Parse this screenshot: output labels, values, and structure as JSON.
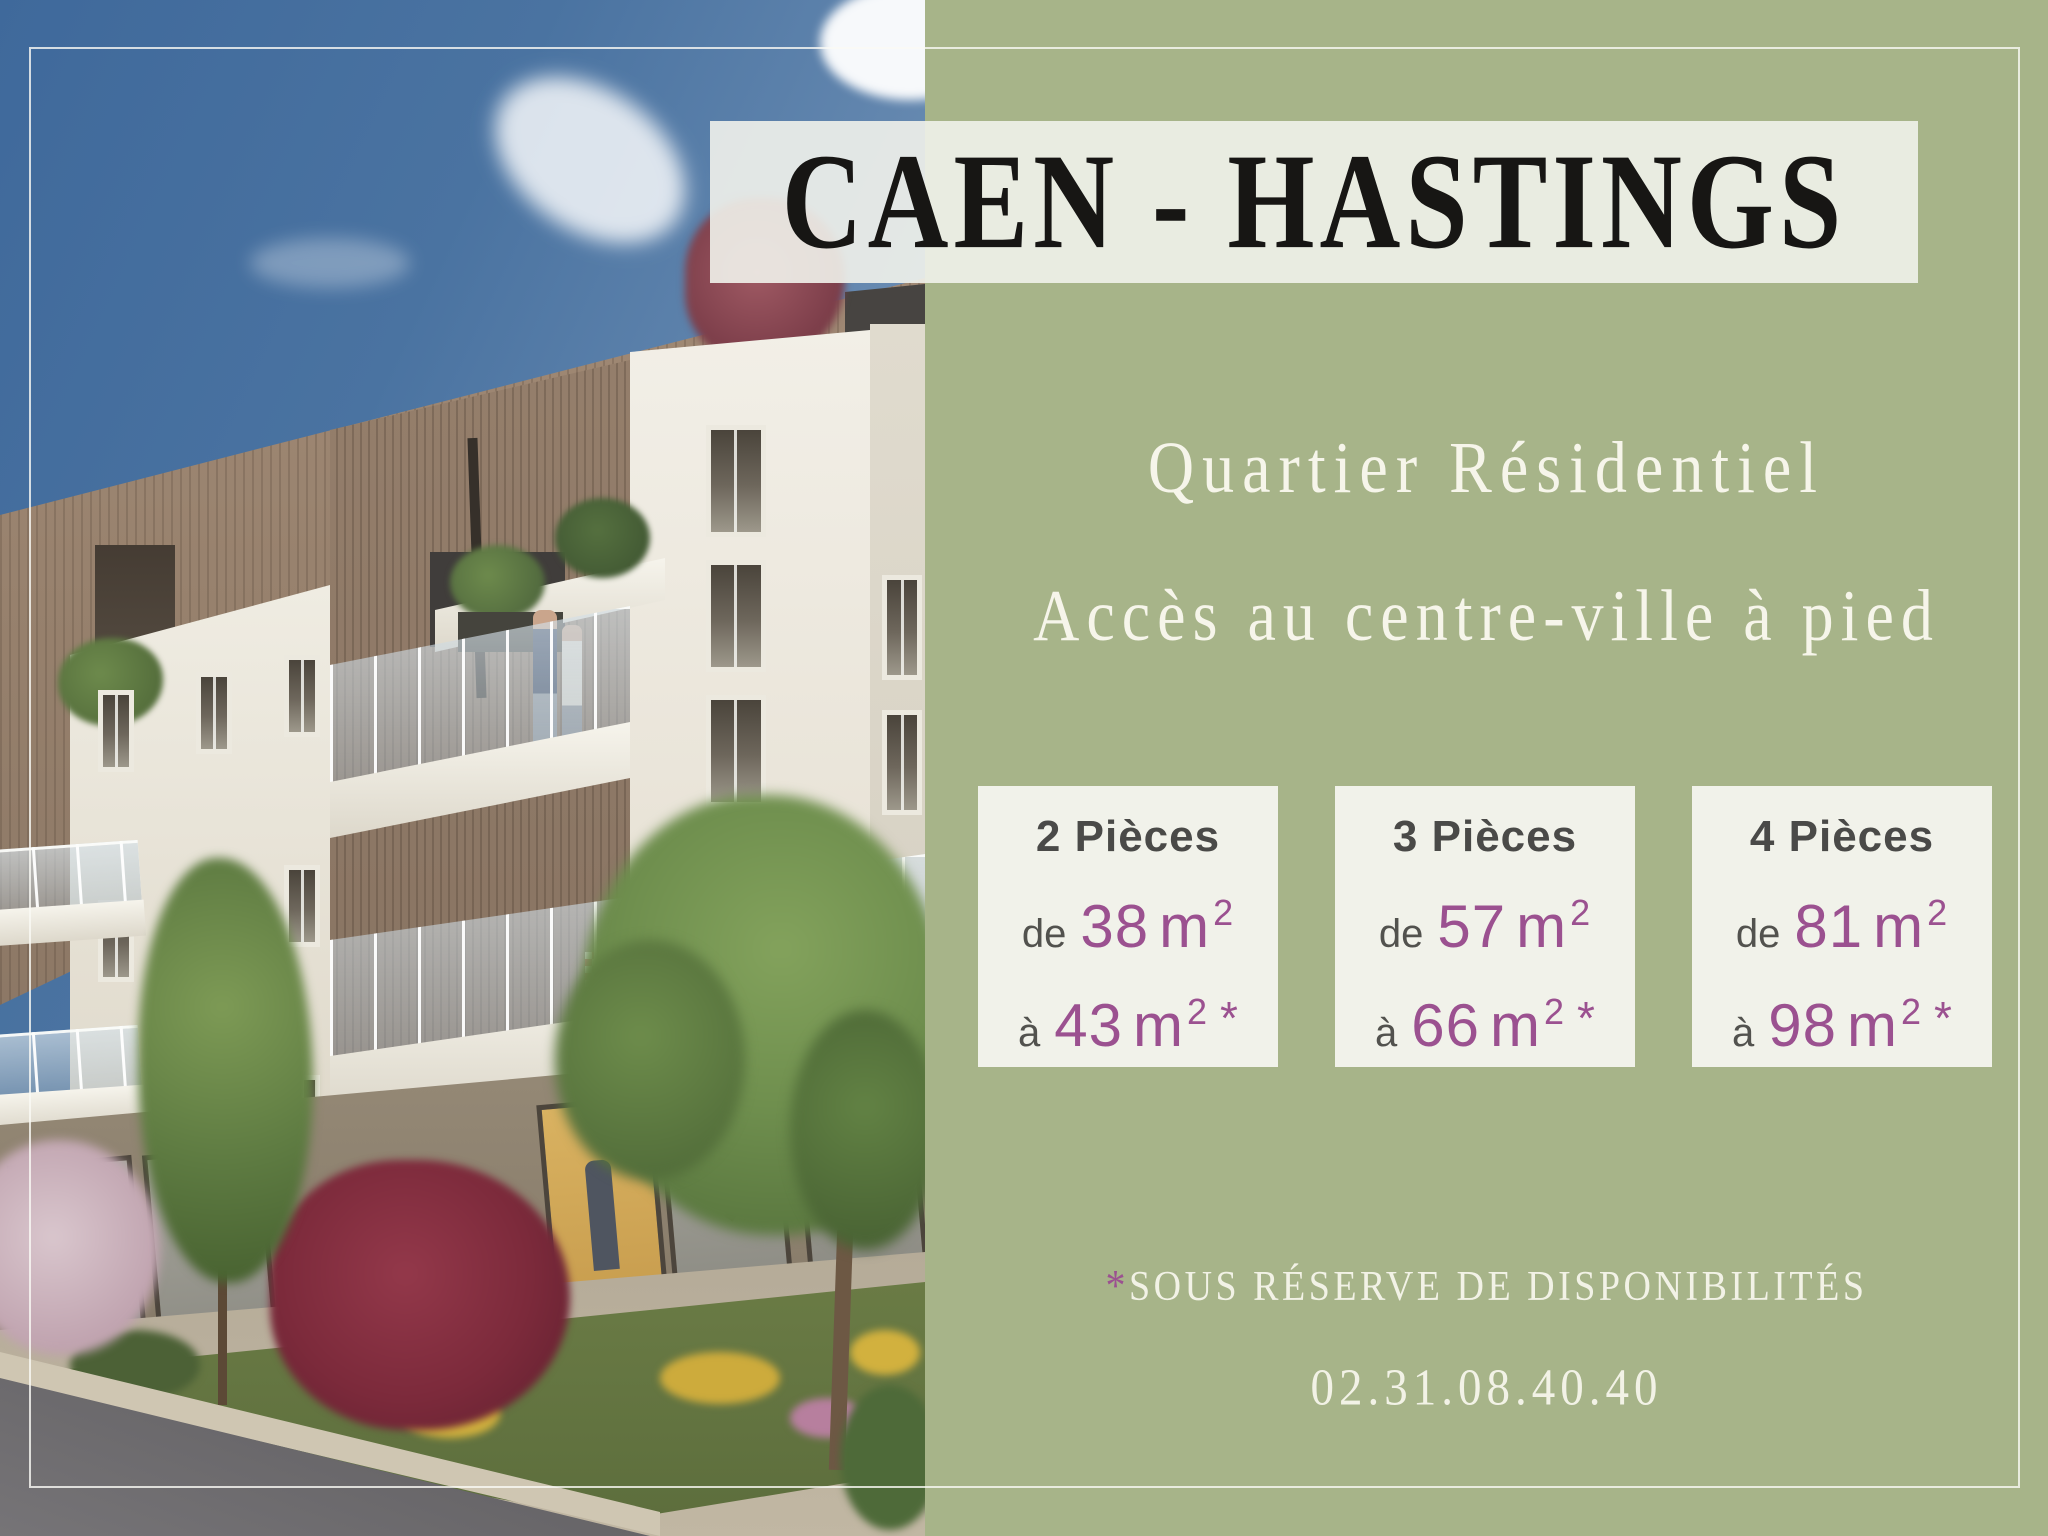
{
  "header": {
    "title": "CAEN - HASTINGS"
  },
  "panel": {
    "subtitle1": "Quartier Résidentiel",
    "subtitle2": "Accès au centre-ville à pied",
    "cards": [
      {
        "title": "2 Pièces",
        "from_label": "de",
        "from_value": "38",
        "to_label": "à",
        "to_value": "43",
        "unit": "m",
        "exponent": "2",
        "asterisk": "*"
      },
      {
        "title": "3 Pièces",
        "from_label": "de",
        "from_value": "57",
        "to_label": "à",
        "to_value": "66",
        "unit": "m",
        "exponent": "2",
        "asterisk": "*"
      },
      {
        "title": "4 Pièces",
        "from_label": "de",
        "from_value": "81",
        "to_label": "à",
        "to_value": "98",
        "unit": "m",
        "exponent": "2",
        "asterisk": "*"
      }
    ],
    "disclaimer": {
      "asterisk": "*",
      "text": "SOUS RÉSERVE DE DISPONIBILITÉS"
    },
    "phone": "02.31.08.40.40"
  },
  "colors": {
    "background_green": "#a7b489",
    "card_background": "#f1f2ea",
    "accent_purple": "#9b5190",
    "title_ink": "#171614",
    "ivory_text": "#f2f2e6",
    "grey_text": "#4a4a48",
    "sky_blue": "#4a73a1",
    "frame_line": "#fafaf5"
  }
}
